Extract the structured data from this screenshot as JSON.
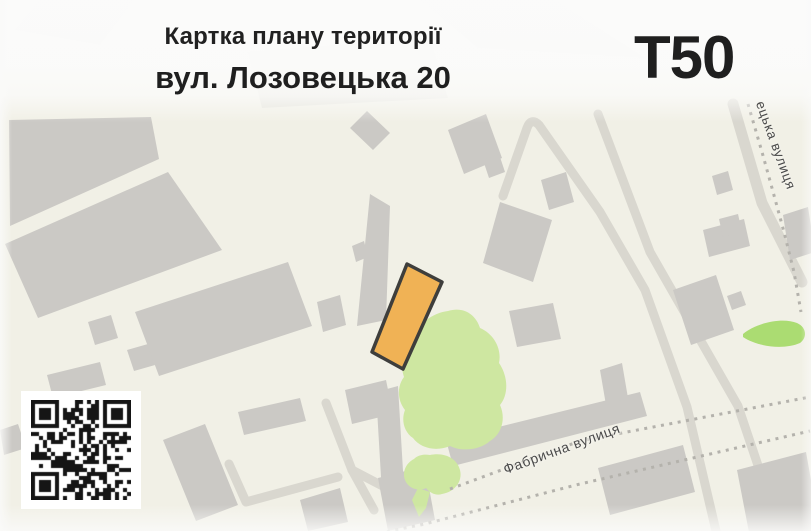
{
  "header": {
    "title": "Картка плану території",
    "address": "вул. Лозовецька 20",
    "plan_code": "T50"
  },
  "map": {
    "street_labels": [
      {
        "name": "Фабрична вулиця"
      },
      {
        "name": "ецька вулиця"
      }
    ],
    "colors": {
      "map_background": "#f1f0e6",
      "building": "#cbc9c5",
      "road": "#d9d7cf",
      "railway_dot": "#b4b2ac",
      "green_area": "#cee7a1",
      "green_leaf": "#abdc72",
      "parcel_fill": "#f0b255",
      "parcel_border": "#3e3e3c",
      "street_label": "#4a4a4a",
      "title": "#212121",
      "qr_module": "#151515",
      "qr_background": "#ffffff"
    }
  }
}
